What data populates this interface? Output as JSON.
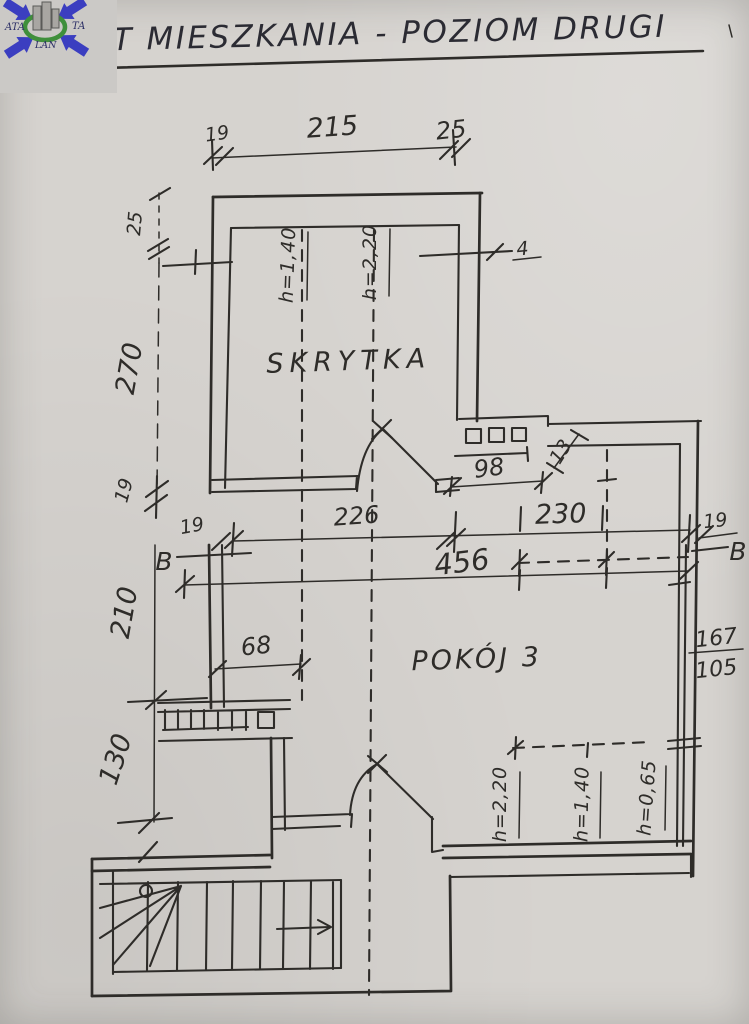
{
  "page": {
    "title": "RZUT MIESZKANIA - POZIOM DRUGI"
  },
  "logo": {
    "text_left": "ATA",
    "text_right": "TA",
    "text_bottom": "LAN"
  },
  "rooms": {
    "skrytka": "SKRYTKA",
    "pokoj": "POKÓJ 3"
  },
  "dims": {
    "top_19": "19",
    "top_215": "215",
    "top_25": "25",
    "left_25": "25",
    "left_270": "270",
    "left_19": "19",
    "left_210": "210",
    "left_130": "130",
    "wall_19_left": "19",
    "wall_19_right": "19",
    "d226": "226",
    "d230": "230",
    "d456": "456",
    "d98": "98",
    "d68": "68",
    "d13": "13",
    "d167": "167",
    "d105": "105",
    "mark_4": "4"
  },
  "heights": {
    "skrytka_h140": "h=1,40",
    "skrytka_h220": "h=2,20",
    "pokoj_h220": "h=2,20",
    "pokoj_h140": "h=1,40",
    "pokoj_h065": "h=0,65"
  },
  "section": {
    "left": "B",
    "right": "B"
  },
  "colors": {
    "ink": "#2e2c29",
    "paper": "#d6d3cf",
    "logo_blue": "#3b3ec0",
    "logo_green": "#3f8f3b",
    "logo_text": "#2c2f66"
  }
}
